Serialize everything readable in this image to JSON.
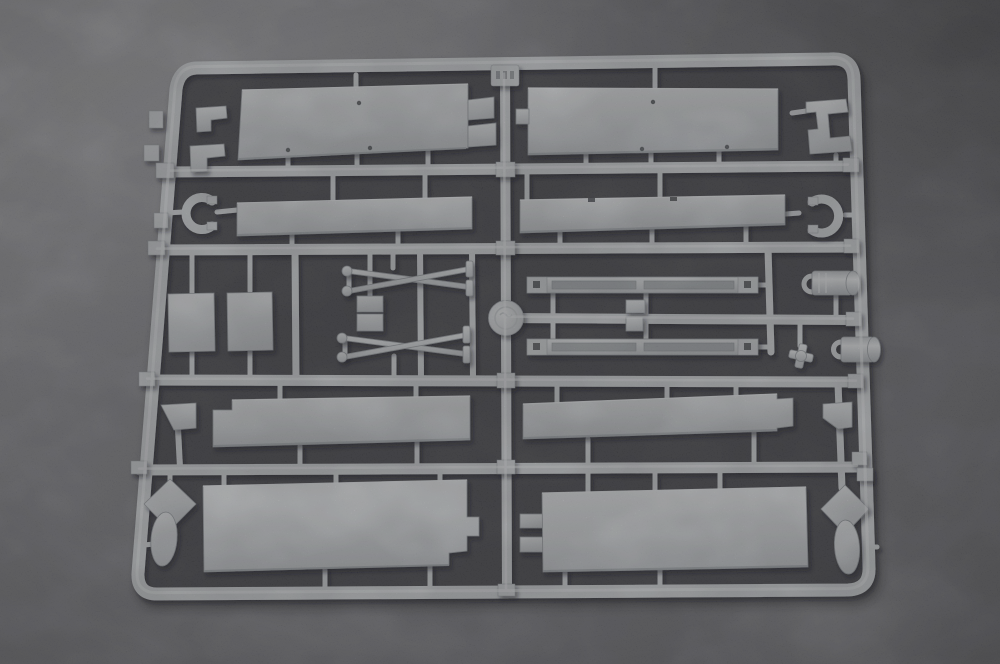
{
  "scene": {
    "type": "photograph",
    "subject": "Light-gray injection-molded plastic model kit sprue with flat deck panels, tapered mast rods, slotted rails, winch drums and anchor fittings, lying on dark gray felt fabric",
    "text_visible": "none (only illegible embossed mold marks on the small tab and the round medallion)"
  },
  "colors": {
    "fabric-light": "#939397",
    "fabric-mid": "#7a7a7f",
    "fabric-dark": "#626267",
    "interior": "#47474c",
    "plastic": "#c6c9cc",
    "plastic-light": "#e0e2e4",
    "plastic-dark": "#92969b",
    "hole": "#5b5f64",
    "shadow": "#17171b"
  },
  "parts": [
    {
      "id": "frame",
      "label": "outer sprue frame with rounded corners"
    },
    {
      "id": "runner-r1",
      "label": "horizontal runner 1"
    },
    {
      "id": "runner-r2",
      "label": "horizontal runner 2"
    },
    {
      "id": "runner-r3",
      "label": "horizontal runner 3 (right half)"
    },
    {
      "id": "runner-r4",
      "label": "horizontal runner 4"
    },
    {
      "id": "runner-r5",
      "label": "horizontal runner 5"
    },
    {
      "id": "runner-center-column",
      "label": "central vertical runner"
    },
    {
      "id": "sprue-id-tab",
      "label": "embossed number tab, top center"
    },
    {
      "id": "sprue-id-disc",
      "label": "round embossed medallion, center"
    },
    {
      "id": "deck-panel-top-left",
      "label": "large flat panel with fork end"
    },
    {
      "id": "deck-panel-top-right",
      "label": "large flat panel with side tab"
    },
    {
      "id": "strip-panel-mid-left",
      "label": "long thin strip panel"
    },
    {
      "id": "strip-panel-mid-right",
      "label": "long thin strip panel"
    },
    {
      "id": "bracket-top-right",
      "label": "stepped C-bracket"
    },
    {
      "id": "c-clamp-left",
      "label": "horseshoe clamp part"
    },
    {
      "id": "c-clamp-right",
      "label": "horseshoe clamp part"
    },
    {
      "id": "mounting-plate-1",
      "label": "small rectangular plate"
    },
    {
      "id": "mounting-plate-2",
      "label": "small rectangular plate"
    },
    {
      "id": "mast-rods-upper",
      "label": "pair of tapered mast rods"
    },
    {
      "id": "mast-rods-lower",
      "label": "pair of tapered mast rods"
    },
    {
      "id": "rigging-blocks",
      "label": "two small block plates"
    },
    {
      "id": "slotted-rail-upper",
      "label": "long slotted rail"
    },
    {
      "id": "slotted-rail-lower",
      "label": "long slotted rail"
    },
    {
      "id": "rail-center-blocks",
      "label": "small center blocks"
    },
    {
      "id": "winch-drum-upper",
      "label": "cylindrical drum with eye"
    },
    {
      "id": "winch-drum-lower",
      "label": "cylindrical drum with eye"
    },
    {
      "id": "valve-wheel",
      "label": "small cross wheel fitting"
    },
    {
      "id": "hull-panel-mid-left",
      "label": "long flat panel"
    },
    {
      "id": "hull-panel-mid-right",
      "label": "long flat panel with end step"
    },
    {
      "id": "wedge-left",
      "label": "small wedge part"
    },
    {
      "id": "wedge-right",
      "label": "small wedge part"
    },
    {
      "id": "hull-panel-bottom-left",
      "label": "large flat panel with tab"
    },
    {
      "id": "hull-panel-bottom-right",
      "label": "large flat panel with fork end"
    },
    {
      "id": "anchor-fitting-left",
      "label": "kite-shaped plate with teardrop fairing"
    },
    {
      "id": "anchor-fitting-right",
      "label": "kite-shaped plate with teardrop fairing"
    },
    {
      "id": "bracket-l-1",
      "label": "small stepped bracket"
    },
    {
      "id": "bracket-l-2",
      "label": "small stepped bracket"
    }
  ]
}
